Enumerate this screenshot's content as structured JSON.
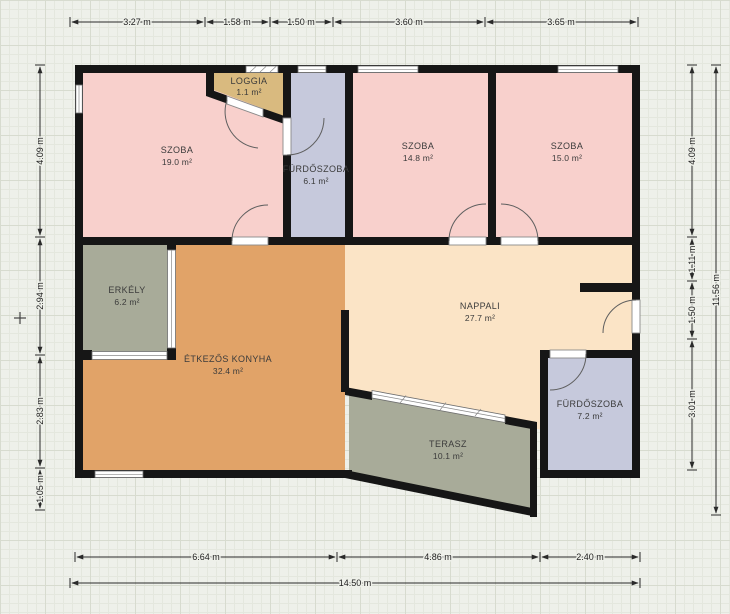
{
  "plan_title": "Floor plan",
  "colors": {
    "wall": "#161616",
    "background": "#eef0ea",
    "room_pink": "#f8d0cc",
    "room_tan": "#d9ba7f",
    "room_lavender": "#c6c9dc",
    "room_cream": "#fbe4c6",
    "room_orange": "#e1a368",
    "room_gray_green": "#a8ab99",
    "dimension_text": "#222222"
  },
  "rooms": [
    {
      "id": "szoba-19",
      "name": "SZOBA",
      "area": "19.0 m²",
      "color": "#f8d0cc"
    },
    {
      "id": "loggia",
      "name": "LOGGIA",
      "area": "1.1 m²",
      "color": "#d9ba7f"
    },
    {
      "id": "furdoszoba-6",
      "name": "FÜRDŐSZOBA",
      "area": "6.1 m²",
      "color": "#c6c9dc"
    },
    {
      "id": "szoba-14",
      "name": "SZOBA",
      "area": "14.8 m²",
      "color": "#f8d0cc"
    },
    {
      "id": "szoba-15",
      "name": "SZOBA",
      "area": "15.0 m²",
      "color": "#f8d0cc"
    },
    {
      "id": "erkely",
      "name": "ERKÉLY",
      "area": "6.2 m²",
      "color": "#a8ab99"
    },
    {
      "id": "etkezos-konyha",
      "name": "ÉTKEZŐS KONYHA",
      "area": "32.4 m²",
      "color": "#e1a368"
    },
    {
      "id": "nappali",
      "name": "NAPPALI",
      "area": "27.7 m²",
      "color": "#fbe4c6"
    },
    {
      "id": "terasz",
      "name": "TERASZ",
      "area": "10.1 m²",
      "color": "#a8ab99"
    },
    {
      "id": "furdoszoba-7",
      "name": "FÜRDŐSZOBA",
      "area": "7.2 m²",
      "color": "#c6c9dc"
    }
  ],
  "dimensions": {
    "top": [
      "3.27 m",
      "1.58 m",
      "1.50 m",
      "3.60 m",
      "3.65 m"
    ],
    "left": [
      "4.09 m",
      "2.94 m",
      "2.83 m",
      "1.05 m"
    ],
    "right": [
      "4.09 m",
      "1.11 m",
      "1.50 m",
      "3.01 m"
    ],
    "right_total": "11.56 m",
    "bottom": [
      "6.64 m",
      "4.86 m",
      "2.40 m"
    ],
    "bottom_total": "14.50 m"
  }
}
